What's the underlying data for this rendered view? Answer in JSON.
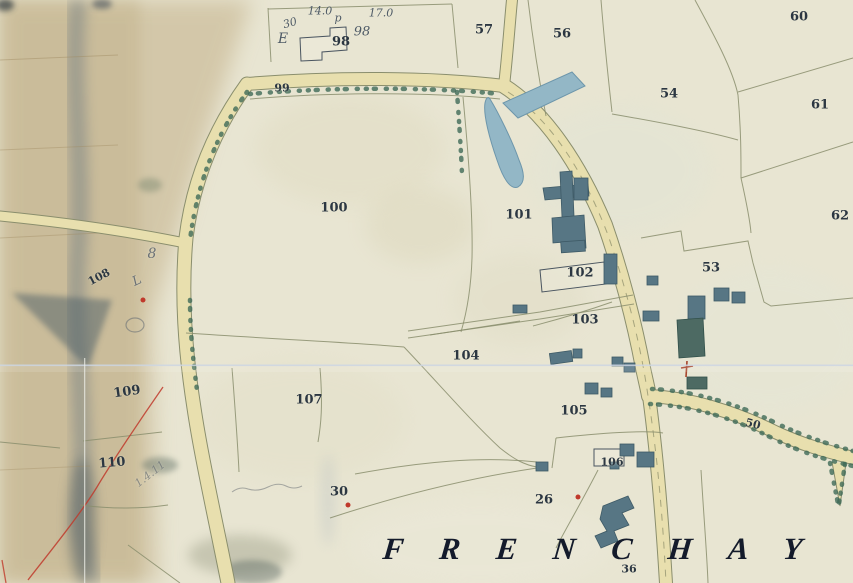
{
  "map": {
    "place_name": "FRENCHAY",
    "labels": {
      "n98": "98",
      "n57": "57",
      "n56": "56",
      "n60": "60",
      "n54": "54",
      "n61": "61",
      "n62": "62",
      "n99": "99",
      "n100": "100",
      "n101": "101",
      "n102": "102",
      "n53": "53",
      "n103": "103",
      "n104": "104",
      "n105": "105",
      "n106": "106",
      "n107": "107",
      "n108": "108",
      "n109": "109",
      "n110": "110",
      "n26": "26",
      "n30": "30",
      "n36": "36",
      "n50": "50"
    },
    "annotations": {
      "top_30": "30",
      "top_140": "14.0",
      "top_p": "p",
      "top_170": "17.0",
      "top_e": "E",
      "top_98": "98",
      "pencil_8": "8",
      "pencil_l": "L",
      "pencil_1411": "1.4.11"
    }
  },
  "colors": {
    "paper": "#e8e5d2",
    "margin": "#c3b088",
    "road": "#e8dfae",
    "line": "#8a8e6d",
    "hedge": "#3e6a57",
    "water": "#93b7c6",
    "building": "#577684",
    "ink": "#2c3742",
    "pencil": "#6b7176",
    "red": "#c0392b",
    "navy": "#141b2b",
    "stain": "#5f6f7e"
  }
}
